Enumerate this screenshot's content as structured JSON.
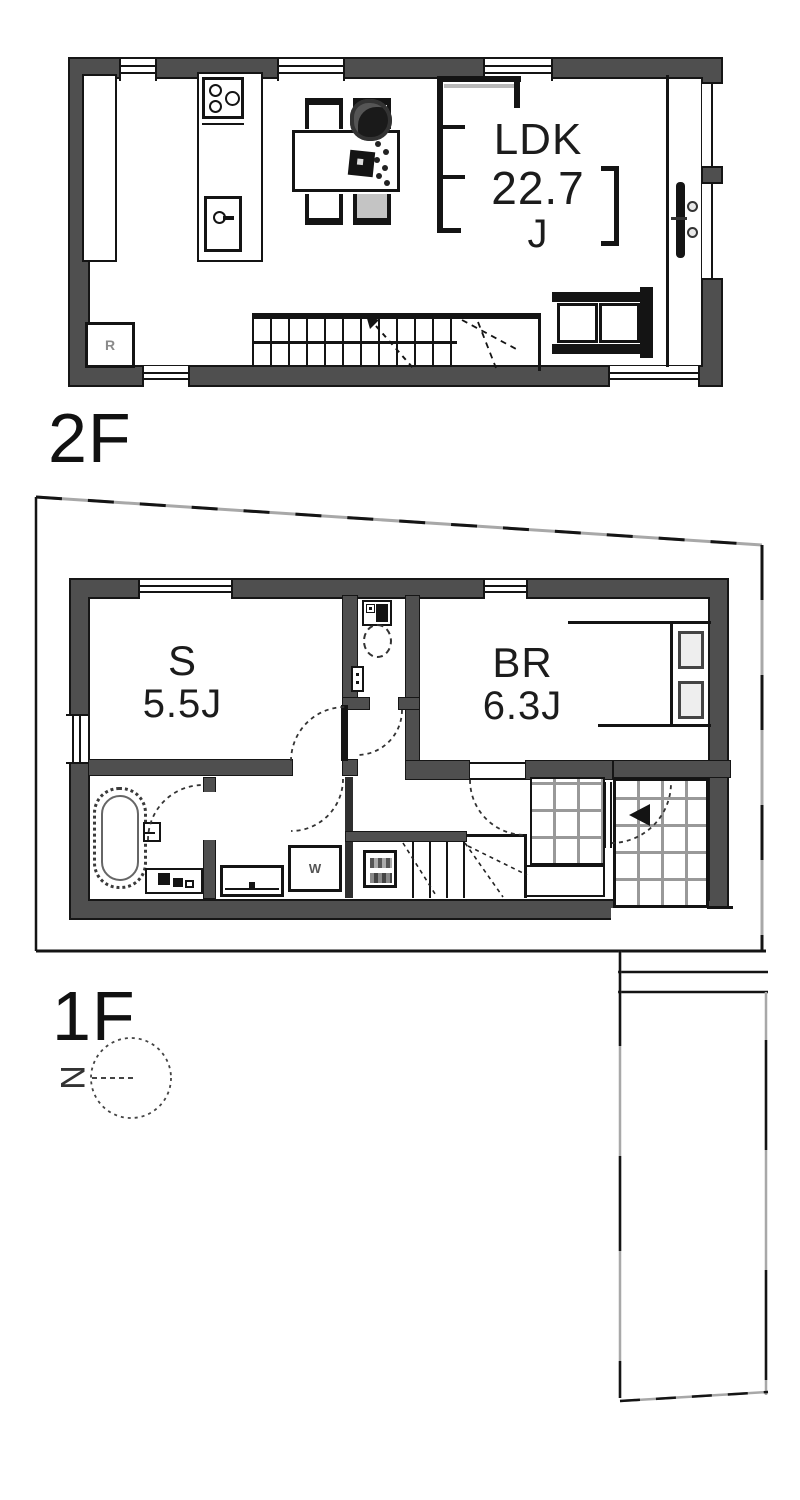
{
  "page": {
    "background": "#ffffff"
  },
  "floor2": {
    "label": "2F",
    "room": {
      "name": "LDK",
      "area": "22.7",
      "unit": "J"
    },
    "fridge_label": "R"
  },
  "floor1": {
    "label": "1F",
    "storage_room": {
      "name": "S",
      "area": "5.5J"
    },
    "bedroom": {
      "name": "BR",
      "area": "6.3J"
    },
    "washer_label": "W"
  },
  "compass": {
    "north_label": "N"
  },
  "colors": {
    "wall": "#4f4f4f",
    "line": "#111111",
    "boundary_gray": "#a0a0a0",
    "tile_grout": "#999999",
    "text": "#1c1c1c"
  }
}
